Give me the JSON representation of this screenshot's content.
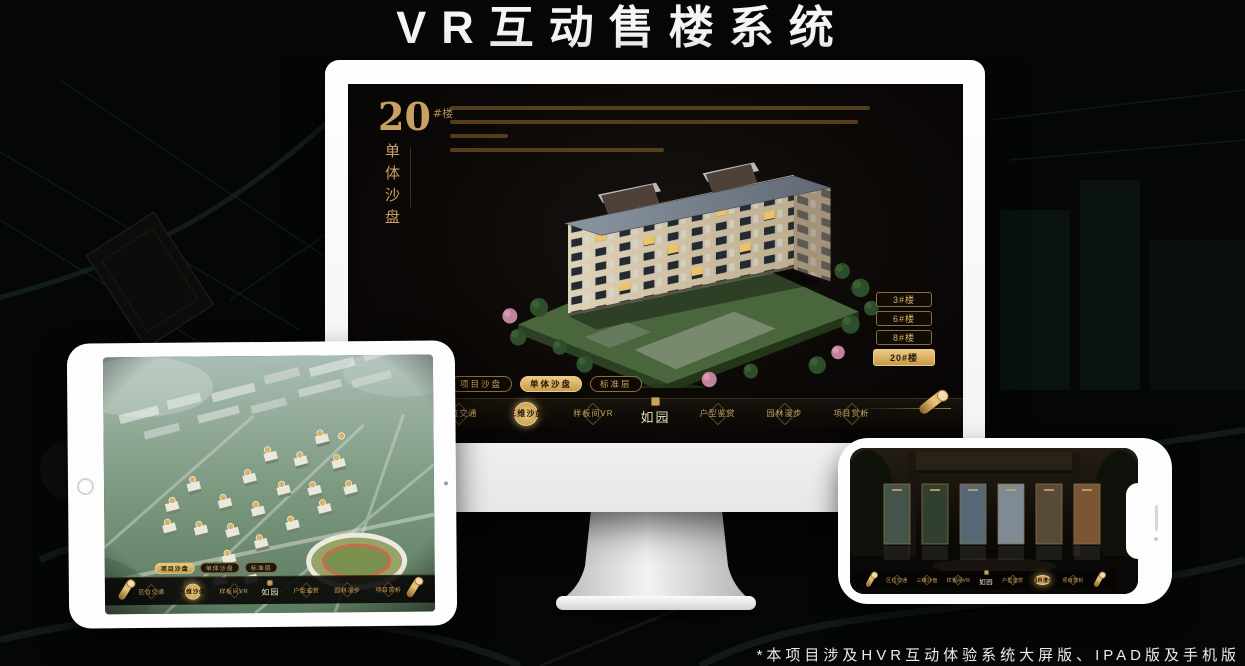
{
  "header": {
    "title": "VR互动售楼系统"
  },
  "footer": {
    "note": "*本项目涉及HVR互动体验系统大屏版、IPAD版及手机版"
  },
  "brand": {
    "name": "如园"
  },
  "colors": {
    "gold": "#c9a063",
    "gold_bright": "#ecca81",
    "screen_bg": "#0b0806"
  },
  "monitor": {
    "heading": {
      "number": "20",
      "unit": "#楼",
      "subtitle": "单体沙盘"
    },
    "floor_buttons": [
      {
        "label": "3#楼"
      },
      {
        "label": "6#楼"
      },
      {
        "label": "8#楼"
      },
      {
        "label": "20#楼"
      }
    ],
    "sub_tabs": [
      {
        "label": "项目沙盘"
      },
      {
        "label": "单体沙盘"
      },
      {
        "label": "标准层"
      }
    ],
    "nav_items": [
      {
        "label": "区位交通"
      },
      {
        "label": "三维沙盘"
      },
      {
        "label": "样板间VR"
      },
      {
        "label": "户型鉴赏"
      },
      {
        "label": "园林漫步"
      },
      {
        "label": "项目赏析"
      }
    ]
  },
  "tablet": {
    "sub_tabs": [
      {
        "label": "项目沙盘"
      },
      {
        "label": "单体沙盘"
      },
      {
        "label": "标准层"
      }
    ],
    "nav_items": [
      {
        "label": "区位交通"
      },
      {
        "label": "三维沙盘"
      },
      {
        "label": "样板间VR"
      },
      {
        "label": "户型鉴赏"
      },
      {
        "label": "园林漫步"
      },
      {
        "label": "项目赏析"
      }
    ]
  },
  "phone": {
    "nav_items": [
      {
        "label": "区位交通"
      },
      {
        "label": "三维沙盘"
      },
      {
        "label": "样板间VR"
      },
      {
        "label": "户型鉴赏"
      },
      {
        "label": "园林漫步"
      },
      {
        "label": "项目赏析"
      }
    ]
  }
}
